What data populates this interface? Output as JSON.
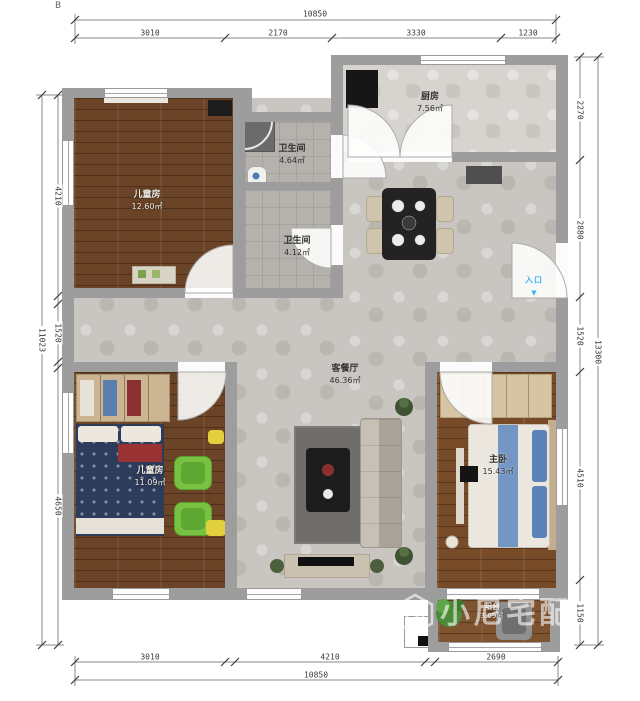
{
  "page": {
    "stray_mark": "B"
  },
  "rooms": {
    "kitchen": {
      "name": "厨房",
      "area": "7.56㎡"
    },
    "bath_upper": {
      "name": "卫生间",
      "area": "4.64㎡"
    },
    "bath_lower": {
      "name": "卫生间",
      "area": "4.12㎡"
    },
    "kids_room_upper": {
      "name": "儿童房",
      "area": "12.60㎡"
    },
    "living_dining": {
      "name": "客餐厅",
      "area": "46.36㎡"
    },
    "kids_room_lower": {
      "name": "儿童房",
      "area": "11.09㎡"
    },
    "master_bedroom": {
      "name": "主卧",
      "area": "15.43㎡"
    },
    "balcony": {
      "name": "阳台",
      "area": "3.09㎡"
    }
  },
  "entry": {
    "label": "入口",
    "arrow": "▼"
  },
  "dimensions": {
    "top": {
      "total": "10850",
      "segments": [
        "3010",
        "2170",
        "3330",
        "1230"
      ]
    },
    "bottom": {
      "total": "10850",
      "segments": [
        "3010",
        "4210",
        "2690"
      ]
    },
    "left": {
      "total": "11023",
      "segments": [
        "4210",
        "1520",
        "4650"
      ]
    },
    "right": {
      "total": "13300",
      "segments": [
        "2270",
        "2880",
        "1520",
        "4510",
        "1150"
      ]
    }
  },
  "watermark": {
    "brand": "小尼宅配"
  },
  "colors": {
    "wall": "#9d9d9d",
    "tile": "#c9c6c1",
    "kitchen_tile": "#d7d4cf",
    "bath_tile": "#b5b2ae",
    "wood": "#6b4326",
    "wood_master": "#784b28",
    "entry_blue": "#3fb6ef",
    "chair_green": "#79c143",
    "bed_navy": "#2d3c5a",
    "pillow_blue": "#5b83b8",
    "watermark_white": "rgba(255,255,255,0.60)"
  }
}
